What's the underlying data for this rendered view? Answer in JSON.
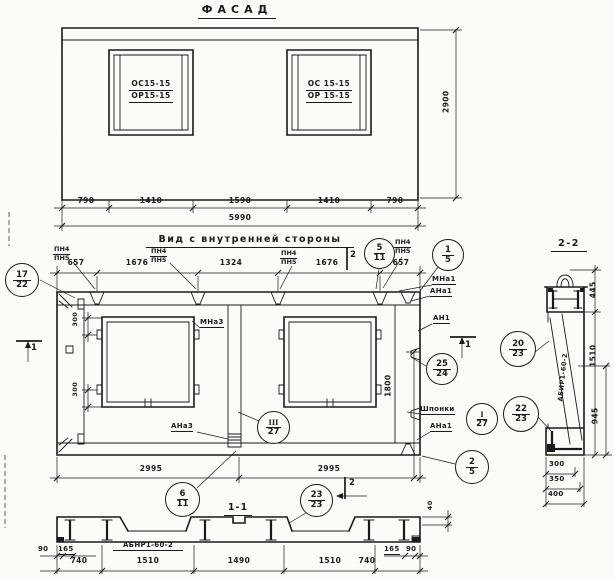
{
  "titles": {
    "facade": "ФАСАД",
    "inner_view": "Вид с внутренней стороны",
    "section_1_1": "1-1",
    "section_2_2": "2-2"
  },
  "facade": {
    "left_window": {
      "top": "ОС15-15",
      "bottom": "ОР15-15"
    },
    "right_window": {
      "top": "ОС 15-15",
      "bottom": "ОР 15-15"
    },
    "dims": [
      "790",
      "1410",
      "1590",
      "1410",
      "790"
    ],
    "total": "5990",
    "height": "2900"
  },
  "inner": {
    "top_dims": [
      "657",
      "1676",
      "1324",
      "1676",
      "657"
    ],
    "pn_labels": [
      {
        "top": "ПН4",
        "bottom": "ПН5"
      },
      {
        "top": "ПН4",
        "bottom": "ПН5"
      },
      {
        "top": "ПН4",
        "bottom": "ПН5"
      },
      {
        "top": "ПН4",
        "bottom": "ПН5"
      }
    ],
    "offset_dims": [
      "300",
      "300"
    ],
    "dim_1800": "1800",
    "bottom_dims": [
      "2995",
      "2995"
    ],
    "labels": {
      "mna3": "МНа3",
      "ana3": "АНа3",
      "mna1": "МНа1",
      "ana1_top": "АНа1",
      "an1": "АН1",
      "shponki": "Шпонки",
      "ana1_bottom": "АНа1"
    },
    "markers": {
      "s1": "1",
      "s2": "2"
    }
  },
  "section11": {
    "product": "АБНР1-60-2",
    "small_dims": {
      "d90l": "90",
      "d165l": "165",
      "d165r": "165",
      "d90r": "90",
      "d40": "40"
    },
    "dims": [
      "740",
      "1510",
      "1490",
      "1510",
      "740"
    ]
  },
  "section22": {
    "product": "АБИР1-60-2",
    "side_dims": [
      "445",
      "1510",
      "945"
    ],
    "bottom_dims": [
      "300",
      "350",
      "400"
    ]
  },
  "callouts": {
    "c17_22": {
      "top": "17",
      "bottom": "22"
    },
    "c5_11": {
      "top": "5",
      "bottom": "11"
    },
    "c1_5": {
      "top": "1",
      "bottom": "5"
    },
    "c25_24": {
      "top": "25",
      "bottom": "24"
    },
    "c3_27": {
      "top": "III",
      "bottom": "27"
    },
    "c1_27": {
      "top": "I",
      "bottom": "27"
    },
    "c2_5": {
      "top": "2",
      "bottom": "5"
    },
    "c6_11": {
      "top": "6",
      "bottom": "11"
    },
    "c23_23": {
      "top": "23",
      "bottom": "23"
    },
    "c20_23": {
      "top": "20",
      "bottom": "23"
    },
    "c22_23": {
      "top": "22",
      "bottom": "23"
    }
  }
}
